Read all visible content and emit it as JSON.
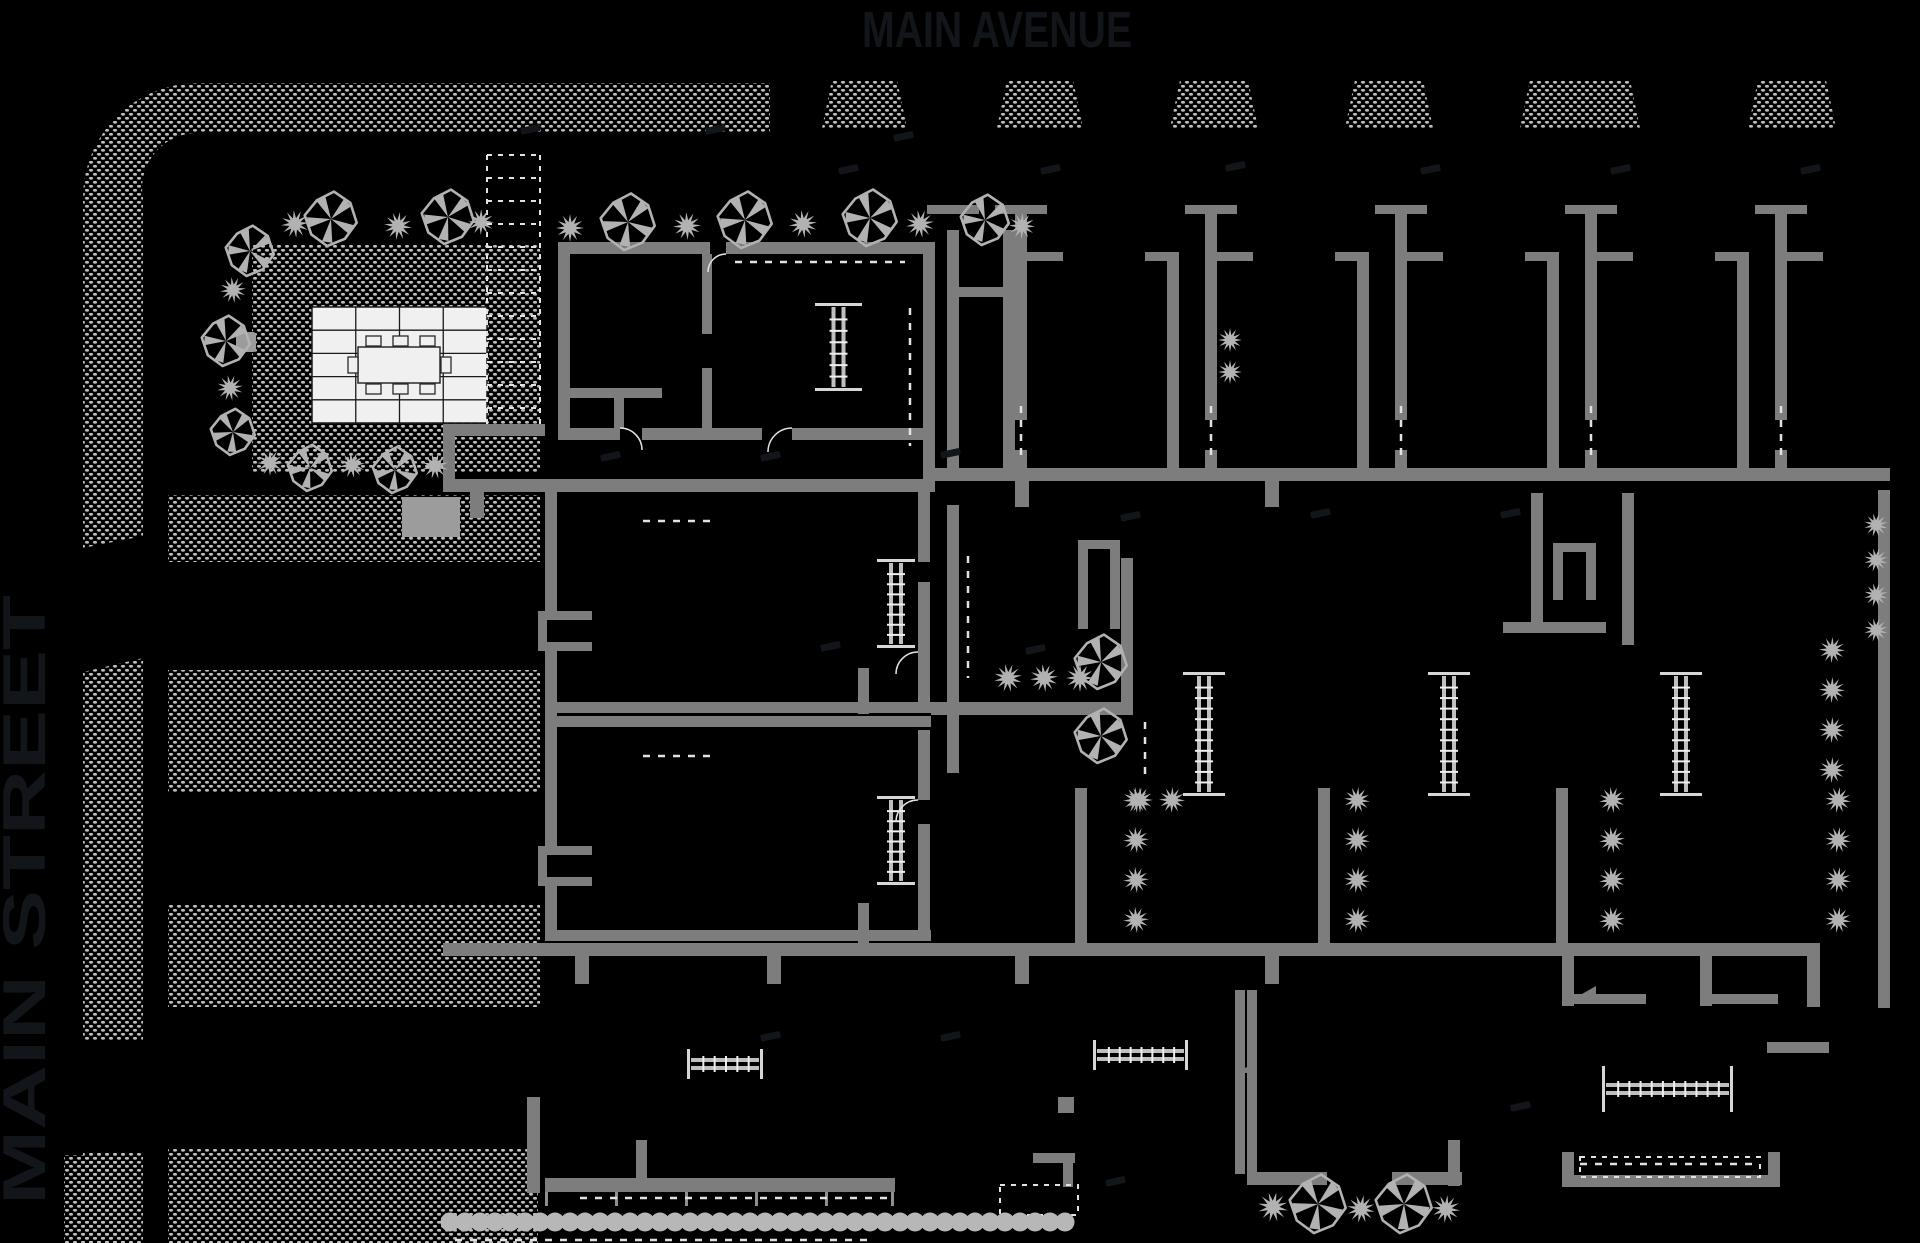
{
  "streets": {
    "top_label": "MAIN AVENUE",
    "left_label": "MAIN STREET"
  },
  "colors": {
    "background": "#000000",
    "wall": "#7d7d7d",
    "wall_light": "#8f8f8f",
    "vegetation": "#b2b2b2",
    "dots": "#c0c0c0",
    "stair_cap": "#d6d6d6",
    "stair_rail": "#bfbfbf",
    "stair_tread": "#efefef",
    "tile_fill": "#f0f0f0",
    "tile_line": "#1a1a1a",
    "dash_line": "#e2e2e2",
    "hedge": "#b7b7b7",
    "planter": "#9c9c9c",
    "street_text": "#12151a",
    "faint": "#121519"
  },
  "canvas": {
    "width": 1920,
    "height": 1243
  },
  "sidewalks": {
    "corner_band_path": "M770,83 L198,83 A115,115 0 0 0 83,198 L83,548 L143,536 L143,198 A55,55 0 0 1 198,133 L770,133 Z",
    "strip_paths": [
      "M83,672 L143,658 L143,1040 L83,1040 Z",
      "M83,1152 L143,1152 L143,1243 L83,1243 Z",
      "M64,1155 L127,1155 L127,1243 L64,1243 Z"
    ],
    "wide_rects": [
      [
        168,
        495,
        372,
        67
      ],
      [
        168,
        670,
        372,
        122
      ],
      [
        168,
        905,
        372,
        102
      ],
      [
        168,
        1148,
        370,
        95
      ]
    ],
    "garden_rect": [
      252,
      245,
      288,
      227
    ],
    "trapezoids": [
      [
        822,
        907
      ],
      [
        997,
        1083
      ],
      [
        1170,
        1258
      ],
      [
        1345,
        1433
      ],
      [
        1520,
        1640
      ],
      [
        1748,
        1836
      ]
    ],
    "trapezoid_y": [
      80,
      128
    ],
    "trapezoid_inset": 10
  },
  "garden": {
    "patio": {
      "x": 312,
      "y": 307,
      "w": 175,
      "h": 116,
      "cols": 4,
      "rows": 5
    },
    "table": {
      "x": 358,
      "y": 347,
      "w": 82,
      "h": 36
    },
    "chairs": [
      [
        366,
        336,
        15,
        10
      ],
      [
        393,
        336,
        15,
        10
      ],
      [
        420,
        336,
        15,
        10
      ],
      [
        366,
        384,
        15,
        10
      ],
      [
        393,
        384,
        15,
        10
      ],
      [
        420,
        384,
        15,
        10
      ],
      [
        348,
        357,
        10,
        16
      ],
      [
        441,
        357,
        10,
        16
      ]
    ],
    "bench": [
      236,
      332,
      20,
      20
    ],
    "trellis": {
      "x": 487,
      "y": 155,
      "w": 53,
      "h": 276,
      "step": 23
    },
    "planter": [
      402,
      497,
      58,
      40
    ]
  },
  "plan": {
    "walls": [
      [
        558,
        242,
        152,
        12
      ],
      [
        726,
        242,
        209,
        12
      ],
      [
        558,
        254,
        12,
        186
      ],
      [
        923,
        242,
        12,
        240
      ],
      [
        558,
        428,
        62,
        12
      ],
      [
        642,
        428,
        120,
        12
      ],
      [
        792,
        428,
        131,
        12
      ],
      [
        702,
        254,
        10,
        80
      ],
      [
        702,
        368,
        10,
        60
      ],
      [
        570,
        388,
        92,
        10
      ],
      [
        614,
        398,
        10,
        30
      ],
      [
        443,
        424,
        102,
        12
      ],
      [
        443,
        436,
        12,
        56
      ],
      [
        443,
        479,
        492,
        13
      ],
      [
        935,
        468,
        955,
        13
      ],
      [
        443,
        943,
        1364,
        13
      ],
      [
        1807,
        943,
        13,
        64
      ],
      [
        545,
        930,
        386,
        11
      ],
      [
        545,
        702,
        386,
        11
      ],
      [
        545,
        716,
        386,
        11
      ],
      [
        931,
        702,
        202,
        13
      ],
      [
        545,
        492,
        12,
        120
      ],
      [
        545,
        650,
        12,
        198
      ],
      [
        545,
        886,
        12,
        46
      ],
      [
        538,
        611,
        54,
        9
      ],
      [
        538,
        611,
        9,
        40
      ],
      [
        538,
        642,
        54,
        9
      ],
      [
        538,
        846,
        54,
        9
      ],
      [
        538,
        846,
        9,
        40
      ],
      [
        538,
        877,
        54,
        9
      ],
      [
        918,
        492,
        12,
        70
      ],
      [
        918,
        582,
        12,
        120
      ],
      [
        918,
        730,
        12,
        70
      ],
      [
        918,
        824,
        12,
        106
      ],
      [
        858,
        668,
        11,
        46
      ],
      [
        858,
        903,
        11,
        40
      ],
      [
        947,
        230,
        12,
        250
      ],
      [
        927,
        205,
        52,
        9
      ],
      [
        1003,
        230,
        12,
        250
      ],
      [
        959,
        287,
        44,
        10
      ],
      [
        947,
        505,
        12,
        268
      ],
      [
        1078,
        540,
        42,
        9
      ],
      [
        1078,
        549,
        10,
        80
      ],
      [
        1110,
        549,
        10,
        80
      ],
      [
        1121,
        558,
        12,
        144
      ],
      [
        1878,
        490,
        12,
        518
      ],
      [
        1531,
        493,
        12,
        140
      ],
      [
        1622,
        493,
        12,
        152
      ],
      [
        1553,
        543,
        43,
        9
      ],
      [
        1553,
        552,
        10,
        48
      ],
      [
        1586,
        552,
        10,
        48
      ],
      [
        1503,
        622,
        103,
        11
      ],
      [
        1075,
        788,
        12,
        157
      ],
      [
        1318,
        788,
        12,
        157
      ],
      [
        1556,
        788,
        12,
        157
      ],
      [
        527,
        1097,
        13,
        96
      ],
      [
        636,
        1140,
        11,
        40
      ],
      [
        545,
        1178,
        350,
        14
      ],
      [
        1033,
        1153,
        42,
        10
      ],
      [
        1063,
        1153,
        10,
        34
      ],
      [
        1058,
        1097,
        16,
        16
      ],
      [
        1235,
        990,
        10,
        184
      ],
      [
        1247,
        990,
        10,
        184
      ],
      [
        1247,
        1172,
        80,
        13
      ],
      [
        1392,
        1172,
        70,
        13
      ],
      [
        1448,
        1140,
        12,
        46
      ],
      [
        1562,
        956,
        12,
        50
      ],
      [
        1574,
        994,
        72,
        10
      ],
      [
        1700,
        956,
        12,
        50
      ],
      [
        1712,
        994,
        66,
        10
      ],
      [
        1767,
        1042,
        62,
        11
      ],
      [
        1562,
        1152,
        12,
        35
      ],
      [
        1562,
        1175,
        218,
        12
      ],
      [
        1768,
        1152,
        12,
        35
      ]
    ],
    "units": [
      {
        "x": 1015
      },
      {
        "x": 1205
      },
      {
        "x": 1395
      },
      {
        "x": 1585
      },
      {
        "x": 1775,
        "truncated": true
      }
    ],
    "stubs": [
      [
        470,
        492,
        14,
        26
      ],
      [
        1015,
        481,
        14,
        26
      ],
      [
        1265,
        481,
        14,
        26
      ],
      [
        575,
        956,
        14,
        28
      ],
      [
        767,
        956,
        14,
        28
      ],
      [
        1015,
        956,
        14,
        28
      ],
      [
        1265,
        956,
        14,
        28
      ]
    ],
    "stairs": [
      [
        815,
        303,
        47,
        88,
        "v"
      ],
      [
        877,
        559,
        38,
        89,
        "v"
      ],
      [
        877,
        796,
        38,
        89,
        "v"
      ],
      [
        1183,
        672,
        42,
        124,
        "v"
      ],
      [
        1428,
        672,
        42,
        124,
        "v"
      ],
      [
        1660,
        672,
        42,
        124,
        "v"
      ],
      [
        687,
        1049,
        76,
        30,
        "h"
      ],
      [
        1093,
        1040,
        95,
        30,
        "h"
      ],
      [
        1602,
        1066,
        131,
        46,
        "h"
      ]
    ],
    "dashes": [
      [
        735,
        262,
        905,
        262
      ],
      [
        643,
        521,
        713,
        521
      ],
      [
        643,
        756,
        713,
        756
      ],
      [
        910,
        308,
        910,
        446
      ],
      [
        968,
        556,
        968,
        678
      ],
      [
        1145,
        722,
        1145,
        774
      ],
      [
        580,
        1198,
        888,
        1198
      ],
      [
        1580,
        1164,
        1758,
        1164
      ],
      [
        455,
        1240,
        875,
        1240
      ]
    ],
    "arcs": [
      {
        "d": "M620,428 A22,22 0 0 1 642,450"
      },
      {
        "d": "M792,428 A24,24 0 0 0 768,452"
      },
      {
        "d": "M918,652 A22,22 0 0 0 896,674"
      },
      {
        "d": "M918,800 A22,22 0 0 0 896,822"
      },
      {
        "d": "M726,254 A18,18 0 0 0 708,272"
      }
    ],
    "triangles": [
      [
        1568,
        1002,
        1596,
        986,
        1596,
        1002
      ],
      [
        1235,
        1073,
        1257,
        1062,
        1257,
        1073
      ]
    ],
    "ticks": [
      545,
      615,
      685,
      755,
      825,
      891
    ],
    "ticks_y": 1192
  },
  "vegetation": {
    "trees": [
      [
        250,
        251,
        24
      ],
      [
        331,
        219,
        26
      ],
      [
        448,
        217,
        26
      ],
      [
        226,
        341,
        24
      ],
      [
        233,
        432,
        22
      ],
      [
        310,
        468,
        22
      ],
      [
        395,
        470,
        22
      ],
      [
        628,
        222,
        27
      ],
      [
        745,
        220,
        27
      ],
      [
        870,
        218,
        27
      ],
      [
        985,
        220,
        24
      ],
      [
        1101,
        662,
        26
      ],
      [
        1101,
        736,
        26
      ],
      [
        1318,
        1204,
        28
      ],
      [
        1404,
        1204,
        28
      ]
    ],
    "shrubs": [
      [
        295,
        224,
        14
      ],
      [
        398,
        226,
        14
      ],
      [
        481,
        222,
        13
      ],
      [
        233,
        290,
        13
      ],
      [
        230,
        388,
        13
      ],
      [
        270,
        463,
        13
      ],
      [
        352,
        465,
        13
      ],
      [
        435,
        466,
        13
      ],
      [
        570,
        228,
        14
      ],
      [
        687,
        226,
        14
      ],
      [
        803,
        224,
        14
      ],
      [
        920,
        224,
        14
      ],
      [
        1022,
        226,
        13
      ],
      [
        1230,
        340,
        12
      ],
      [
        1230,
        372,
        12
      ],
      [
        1008,
        678,
        14
      ],
      [
        1044,
        678,
        14
      ],
      [
        1080,
        678,
        14
      ],
      [
        1140,
        800,
        13
      ],
      [
        1172,
        800,
        13
      ],
      [
        1273,
        1207,
        15
      ],
      [
        1361,
        1209,
        14
      ],
      [
        1446,
        1209,
        14
      ],
      [
        1876,
        525,
        12
      ],
      [
        1876,
        560,
        12
      ],
      [
        1876,
        595,
        12
      ],
      [
        1876,
        630,
        12
      ],
      [
        1832,
        650,
        13
      ],
      [
        1832,
        690,
        13
      ],
      [
        1832,
        730,
        13
      ],
      [
        1832,
        770,
        13
      ]
    ],
    "shrub_strings": {
      "xs": [
        1136,
        1357,
        1612,
        1838
      ],
      "ys": [
        800,
        840,
        880,
        920
      ],
      "r": 13
    },
    "hedge": {
      "x1": 450,
      "x2": 1072,
      "y": 1222,
      "r": 9.5,
      "step": 15
    }
  },
  "faint_marks": [
    [
      520,
      128
    ],
    [
      705,
      128
    ],
    [
      893,
      135
    ],
    [
      838,
      168
    ],
    [
      1040,
      168
    ],
    [
      1225,
      165
    ],
    [
      1420,
      168
    ],
    [
      1610,
      168
    ],
    [
      1800,
      168
    ],
    [
      600,
      455
    ],
    [
      760,
      455
    ],
    [
      940,
      452
    ],
    [
      1120,
      515
    ],
    [
      1310,
      512
    ],
    [
      1500,
      512
    ],
    [
      820,
      645
    ],
    [
      1025,
      648
    ],
    [
      760,
      1035
    ],
    [
      940,
      1035
    ],
    [
      1105,
      1180
    ],
    [
      1510,
      1105
    ]
  ],
  "dashed_rects": [
    [
      1000,
      1185,
      78,
      30
    ],
    [
      1580,
      1157,
      180,
      20
    ]
  ]
}
